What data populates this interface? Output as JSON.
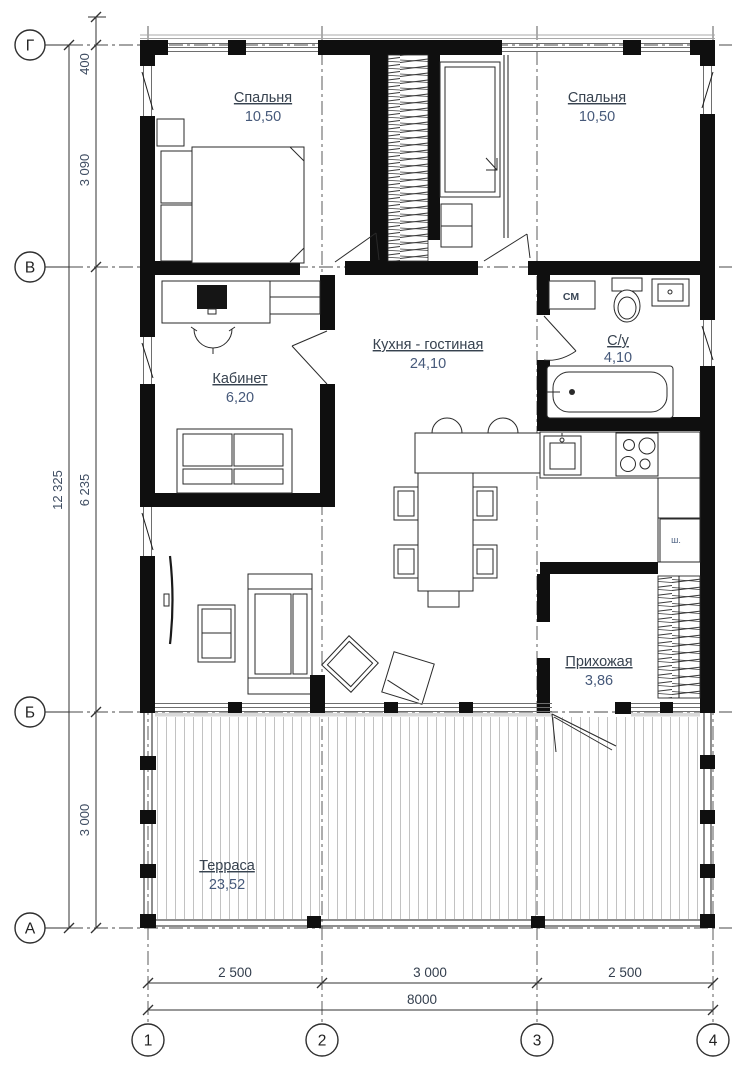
{
  "plan": {
    "rooms": [
      {
        "key": "bedroom_left",
        "name": "Спальня",
        "area": "10,50"
      },
      {
        "key": "bedroom_right",
        "name": "Спальня",
        "area": "10,50"
      },
      {
        "key": "kitchen_living",
        "name": "Кухня - гостиная",
        "area": "24,10"
      },
      {
        "key": "office",
        "name": "Кабинет",
        "area": "6,20"
      },
      {
        "key": "bathroom",
        "name": "С/у",
        "area": "4,10"
      },
      {
        "key": "hallway",
        "name": "Прихожая",
        "area": "3,86"
      },
      {
        "key": "terrace",
        "name": "Терраса",
        "area": "23,52"
      }
    ],
    "annotations": {
      "washing_machine": "СМ",
      "wardrobe": "ш."
    },
    "axes": {
      "rows": [
        "Г",
        "В",
        "Б",
        "А"
      ],
      "cols": [
        "1",
        "2",
        "3",
        "4"
      ]
    },
    "dimensions": {
      "vertical_total": "12 325",
      "vertical_segments": [
        "400",
        "3 090",
        "6 235",
        "3 000"
      ],
      "horizontal_segments": [
        "2 500",
        "3 000",
        "2 500"
      ],
      "horizontal_total": "8000"
    }
  }
}
